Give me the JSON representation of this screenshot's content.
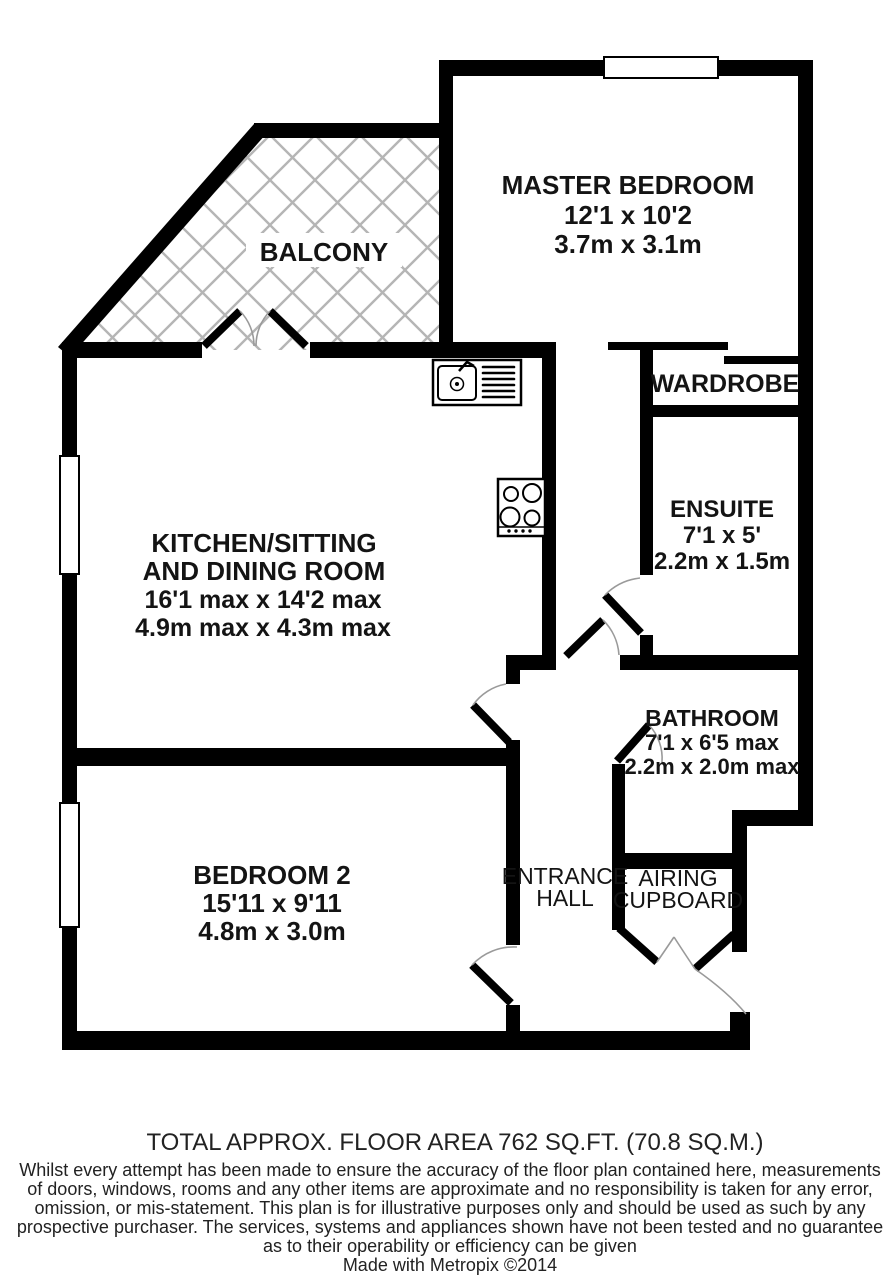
{
  "plan": {
    "rooms": {
      "master_bedroom": {
        "name": "MASTER BEDROOM",
        "size_imperial": "12'1 x 10'2",
        "size_metric": "3.7m x 3.1m"
      },
      "balcony": {
        "name": "BALCONY"
      },
      "kitchen": {
        "name_line1": "KITCHEN/SITTING",
        "name_line2": "AND DINING ROOM",
        "size_imperial": "16'1 max x 14'2 max",
        "size_metric": "4.9m max x 4.3m max"
      },
      "wardrobe": {
        "name": "WARDROBE"
      },
      "ensuite": {
        "name": "ENSUITE",
        "size_imperial": "7'1 x 5'",
        "size_metric": "2.2m x 1.5m"
      },
      "bathroom": {
        "name": "BATHROOM",
        "size_imperial": "7'1 x 6'5 max",
        "size_metric": "2.2m x 2.0m max"
      },
      "bedroom_2": {
        "name": "BEDROOM 2",
        "size_imperial": "15'11 x 9'11",
        "size_metric": "4.8m x 3.0m"
      },
      "entrance_hall": {
        "name_line1": "ENTRANCE",
        "name_line2": "HALL"
      },
      "airing_cupboard": {
        "name_line1": "AIRING",
        "name_line2": "CUPBOARD"
      }
    },
    "fixtures": {
      "sink": "kitchen-sink",
      "hob": "kitchen-hob"
    },
    "colors": {
      "wall": "#000000",
      "hatch": "#b5b5b5",
      "door_arc": "#9a9a9a",
      "text": "#141414"
    }
  },
  "footer": {
    "total_area": "TOTAL APPROX. FLOOR AREA 762 SQ.FT. (70.8 SQ.M.)",
    "disclaimer_lines": [
      "Whilst every attempt has been made to ensure the accuracy of the floor plan contained here, measurements",
      "of doors, windows, rooms and any other items are approximate and no responsibility is taken for any error,",
      "omission, or mis-statement. This plan is for illustrative purposes only and should be used as such by any",
      "prospective purchaser. The services, systems and appliances shown have not been tested and no guarantee",
      "as to their operability or efficiency can be given"
    ],
    "credit": "Made with Metropix ©2014"
  }
}
